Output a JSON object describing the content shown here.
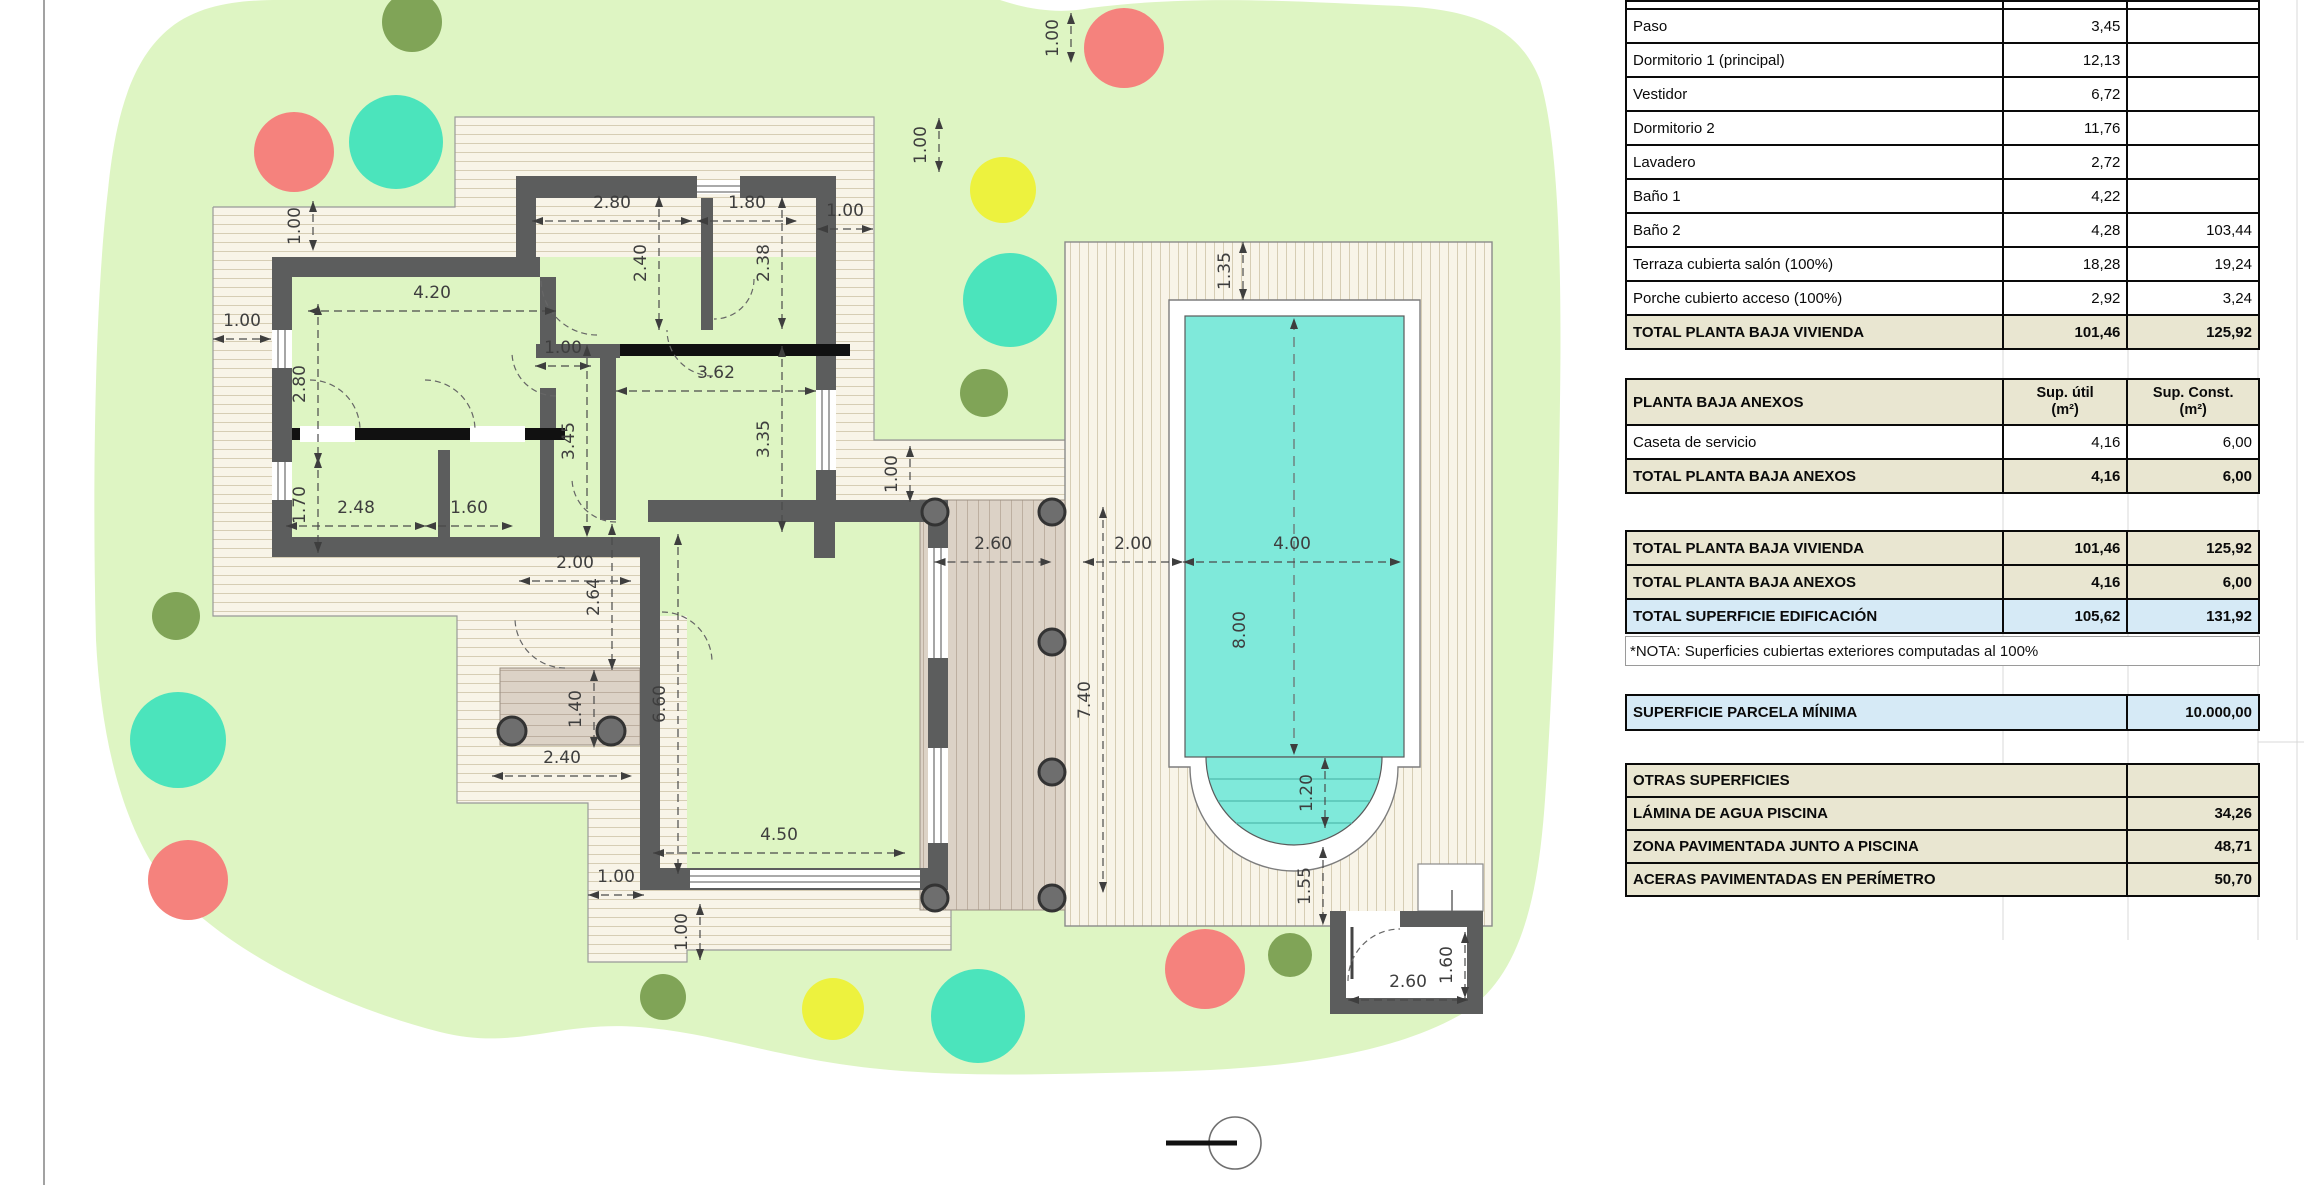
{
  "plan": {
    "colors": {
      "lawn": "#def5c3",
      "deck_bg": "#f8f4e8",
      "deck_line": "#d6cdb4",
      "terrace_bg": "#dcd2c6",
      "terrace_line": "#bdafa0",
      "wall": "#5c5d5d",
      "pool_water": "#7fe9da",
      "tree_red": "#f5827d",
      "tree_teal": "#4be4bc",
      "tree_yellow": "#edf23e",
      "tree_olive": "#80a457"
    },
    "dimensions": [
      {
        "t": "1.00",
        "x": 300,
        "y": 226,
        "o": "v",
        "l": 50
      },
      {
        "t": "1.00",
        "x": 242,
        "y": 326,
        "o": "h",
        "l": 58
      },
      {
        "t": "4.20",
        "x": 432,
        "y": 298,
        "o": "h",
        "l": 248
      },
      {
        "t": "2.80",
        "x": 305,
        "y": 384,
        "o": "v",
        "l": 160
      },
      {
        "t": "1.70",
        "x": 305,
        "y": 505,
        "o": "v",
        "l": 96
      },
      {
        "t": "2.48",
        "x": 356,
        "y": 513,
        "o": "h",
        "l": 140
      },
      {
        "t": "1.60",
        "x": 469,
        "y": 513,
        "o": "h",
        "l": 88
      },
      {
        "t": "2.80",
        "x": 612,
        "y": 208,
        "o": "h",
        "l": 160
      },
      {
        "t": "1.80",
        "x": 747,
        "y": 208,
        "o": "h",
        "l": 100
      },
      {
        "t": "1.00",
        "x": 845,
        "y": 216,
        "o": "h",
        "l": 56
      },
      {
        "t": "2.40",
        "x": 646,
        "y": 263,
        "o": "v",
        "l": 134
      },
      {
        "t": "2.38",
        "x": 769,
        "y": 263,
        "o": "v",
        "l": 132
      },
      {
        "t": "1.00",
        "x": 926,
        "y": 145,
        "o": "v",
        "l": 54
      },
      {
        "t": "1.00",
        "x": 563,
        "y": 353,
        "o": "h",
        "l": 56
      },
      {
        "t": "3.62",
        "x": 716,
        "y": 378,
        "o": "h",
        "l": 200
      },
      {
        "t": "3.45",
        "x": 574,
        "y": 441,
        "o": "v",
        "l": 192
      },
      {
        "t": "3.35",
        "x": 769,
        "y": 439,
        "o": "v",
        "l": 186
      },
      {
        "t": "1.00",
        "x": 897,
        "y": 474,
        "o": "v",
        "l": 56
      },
      {
        "t": "2.00",
        "x": 575,
        "y": 568,
        "o": "h",
        "l": 112
      },
      {
        "t": "2.64",
        "x": 599,
        "y": 597,
        "o": "v",
        "l": 146
      },
      {
        "t": "1.40",
        "x": 581,
        "y": 709,
        "o": "v",
        "l": 78
      },
      {
        "t": "2.40",
        "x": 562,
        "y": 763,
        "o": "h",
        "l": 140
      },
      {
        "t": "6.60",
        "x": 665,
        "y": 704,
        "o": "v",
        "l": 340
      },
      {
        "t": "4.50",
        "x": 779,
        "y": 840,
        "o": "h",
        "l": 252
      },
      {
        "t": "1.00",
        "x": 616,
        "y": 882,
        "o": "h",
        "l": 56
      },
      {
        "t": "1.00",
        "x": 687,
        "y": 932,
        "o": "v",
        "l": 56
      },
      {
        "t": "1.00",
        "x": 1058,
        "y": 38,
        "o": "v",
        "l": 50
      },
      {
        "t": "1.35",
        "x": 1230,
        "y": 271,
        "o": "v",
        "l": 58
      },
      {
        "t": "2.60",
        "x": 993,
        "y": 549,
        "o": "h",
        "l": 117
      },
      {
        "t": "2.00",
        "x": 1133,
        "y": 549,
        "o": "h",
        "l": 100
      },
      {
        "t": "4.00",
        "x": 1292,
        "y": 549,
        "o": "h",
        "l": 218
      },
      {
        "t": "8.00",
        "x": 1245,
        "y": 630,
        "o": "v",
        "l": 0
      },
      {
        "t": "7.40",
        "x": 1090,
        "y": 700,
        "o": "v",
        "l": 386
      },
      {
        "t": "1.20",
        "x": 1312,
        "y": 793,
        "o": "v",
        "l": 70
      },
      {
        "t": "1.55",
        "x": 1310,
        "y": 886,
        "o": "v",
        "l": 78
      },
      {
        "t": "2.60",
        "x": 1408,
        "y": 987,
        "o": "h",
        "l": 120
      },
      {
        "t": "1.60",
        "x": 1452,
        "y": 965,
        "o": "v",
        "l": 66
      }
    ],
    "trees": [
      {
        "x": 412,
        "y": 22,
        "r": 30,
        "c": "olive"
      },
      {
        "x": 294,
        "y": 152,
        "r": 40,
        "c": "red"
      },
      {
        "x": 396,
        "y": 142,
        "r": 47,
        "c": "teal"
      },
      {
        "x": 1124,
        "y": 48,
        "r": 40,
        "c": "red"
      },
      {
        "x": 1003,
        "y": 190,
        "r": 33,
        "c": "yellow"
      },
      {
        "x": 1010,
        "y": 300,
        "r": 47,
        "c": "teal"
      },
      {
        "x": 984,
        "y": 393,
        "r": 24,
        "c": "olive"
      },
      {
        "x": 176,
        "y": 616,
        "r": 24,
        "c": "olive"
      },
      {
        "x": 178,
        "y": 740,
        "r": 48,
        "c": "teal"
      },
      {
        "x": 188,
        "y": 880,
        "r": 40,
        "c": "red"
      },
      {
        "x": 663,
        "y": 997,
        "r": 23,
        "c": "olive"
      },
      {
        "x": 833,
        "y": 1009,
        "r": 31,
        "c": "yellow"
      },
      {
        "x": 978,
        "y": 1016,
        "r": 47,
        "c": "teal"
      },
      {
        "x": 1205,
        "y": 969,
        "r": 40,
        "c": "red"
      },
      {
        "x": 1290,
        "y": 955,
        "r": 22,
        "c": "olive"
      }
    ]
  },
  "areas_table": {
    "vivienda_rows": [
      {
        "label": "Paso",
        "util": "3,45",
        "const": ""
      },
      {
        "label": "Dormitorio 1 (principal)",
        "util": "12,13",
        "const": ""
      },
      {
        "label": "Vestidor",
        "util": "6,72",
        "const": ""
      },
      {
        "label": "Dormitorio 2",
        "util": "11,76",
        "const": ""
      },
      {
        "label": "Lavadero",
        "util": "2,72",
        "const": ""
      },
      {
        "label": "Baño 1",
        "util": "4,22",
        "const": ""
      },
      {
        "label": "Baño 2",
        "util": "4,28",
        "const": "103,44"
      },
      {
        "label": "Terraza cubierta salón (100%)",
        "util": "18,28",
        "const": "19,24"
      },
      {
        "label": "Porche cubierto acceso (100%)",
        "util": "2,92",
        "const": "3,24"
      }
    ],
    "vivienda_total": {
      "label": "TOTAL PLANTA BAJA VIVIENDA",
      "util": "101,46",
      "const": "125,92"
    },
    "anexos_header": {
      "label": "PLANTA BAJA ANEXOS",
      "util": "Sup. útil\n(m²)",
      "const": "Sup. Const.\n(m²)"
    },
    "anexos_rows": [
      {
        "label": "Caseta de servicio",
        "util": "4,16",
        "const": "6,00"
      }
    ],
    "anexos_total": {
      "label": "TOTAL PLANTA BAJA ANEXOS",
      "util": "4,16",
      "const": "6,00"
    },
    "summary_rows": [
      {
        "label": "TOTAL PLANTA BAJA VIVIENDA",
        "util": "101,46",
        "const": "125,92",
        "style": "beige"
      },
      {
        "label": "TOTAL PLANTA BAJA ANEXOS",
        "util": "4,16",
        "const": "6,00",
        "style": "beige"
      },
      {
        "label": "TOTAL SUPERFICIE EDIFICACIÓN",
        "util": "105,62",
        "const": "131,92",
        "style": "blue"
      }
    ],
    "nota": "*NOTA: Superficies cubiertas exteriores computadas al 100%",
    "parcela_minima": {
      "label": "SUPERFICIE PARCELA MÍNIMA",
      "value": "10.000,00"
    },
    "otras_header": "OTRAS SUPERFICIES",
    "otras_rows": [
      {
        "label": "LÁMINA DE AGUA PISCINA",
        "value": "34,26"
      },
      {
        "label": "ZONA PAVIMENTADA JUNTO A PISCINA",
        "value": "48,71"
      },
      {
        "label": "ACERAS PAVIMENTADAS EN PERÍMETRO",
        "value": "50,70"
      }
    ]
  }
}
